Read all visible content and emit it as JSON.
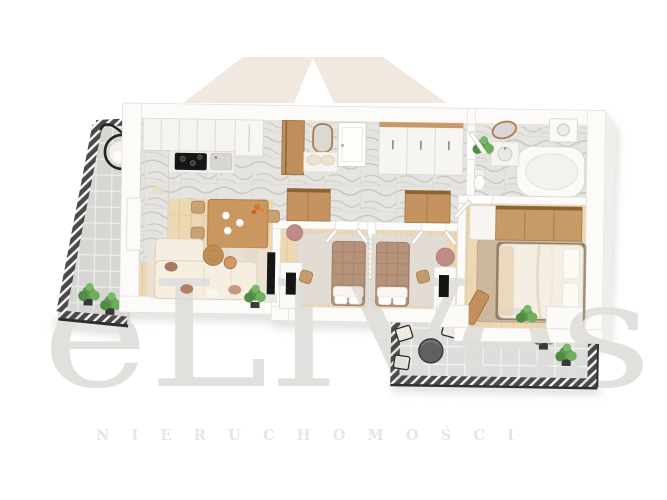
{
  "watermark": {
    "roof_logo": "house-roof-shape",
    "roof_color": "#f1e9e0",
    "brand_text": "eLIVes",
    "brand_color": "#e2e0dd",
    "tagline_text": "NIERUCHOMOŚCI",
    "tagline_color": "#eae5dd"
  },
  "floorplan": {
    "type": "3d-apartment-floor-plan",
    "rooms": [
      "kitchen",
      "dining-area",
      "living-room",
      "hallway",
      "bedroom-1",
      "bedroom-2",
      "master-bedroom",
      "bathroom",
      "left-balcony",
      "terrace"
    ],
    "palette": {
      "wood_floor": "#ecd8b2",
      "wood_plank_line": "#dfc79c",
      "marble_floor": "#e5e4e1",
      "marble_vein": "#b9b5ae",
      "tile_light": "#dddddb",
      "tile_dark": "#d6d6d3",
      "grout": "#f3f3f1",
      "railing_dark": "#4a4a4a",
      "railing_stripe": "#fafafa",
      "wall_white": "#fcfbf9",
      "wall_edge": "#e2dfd8",
      "sofa_cream": "#f6efe1",
      "pillow_brown": "#a9765f",
      "wood_furniture": "#c79a66",
      "bed_tan": "#b5927a",
      "bed_cream": "#f5efe3",
      "desk_white": "#fbfaf7",
      "screen_black": "#161616",
      "plant_green": "#5d9a52",
      "pot_dark": "#383838",
      "pouf_pink": "#bd8d85",
      "rug_beige": "#eae2d6",
      "rug_master": "#cdb79e",
      "shadow": "#c8c5c0"
    }
  }
}
